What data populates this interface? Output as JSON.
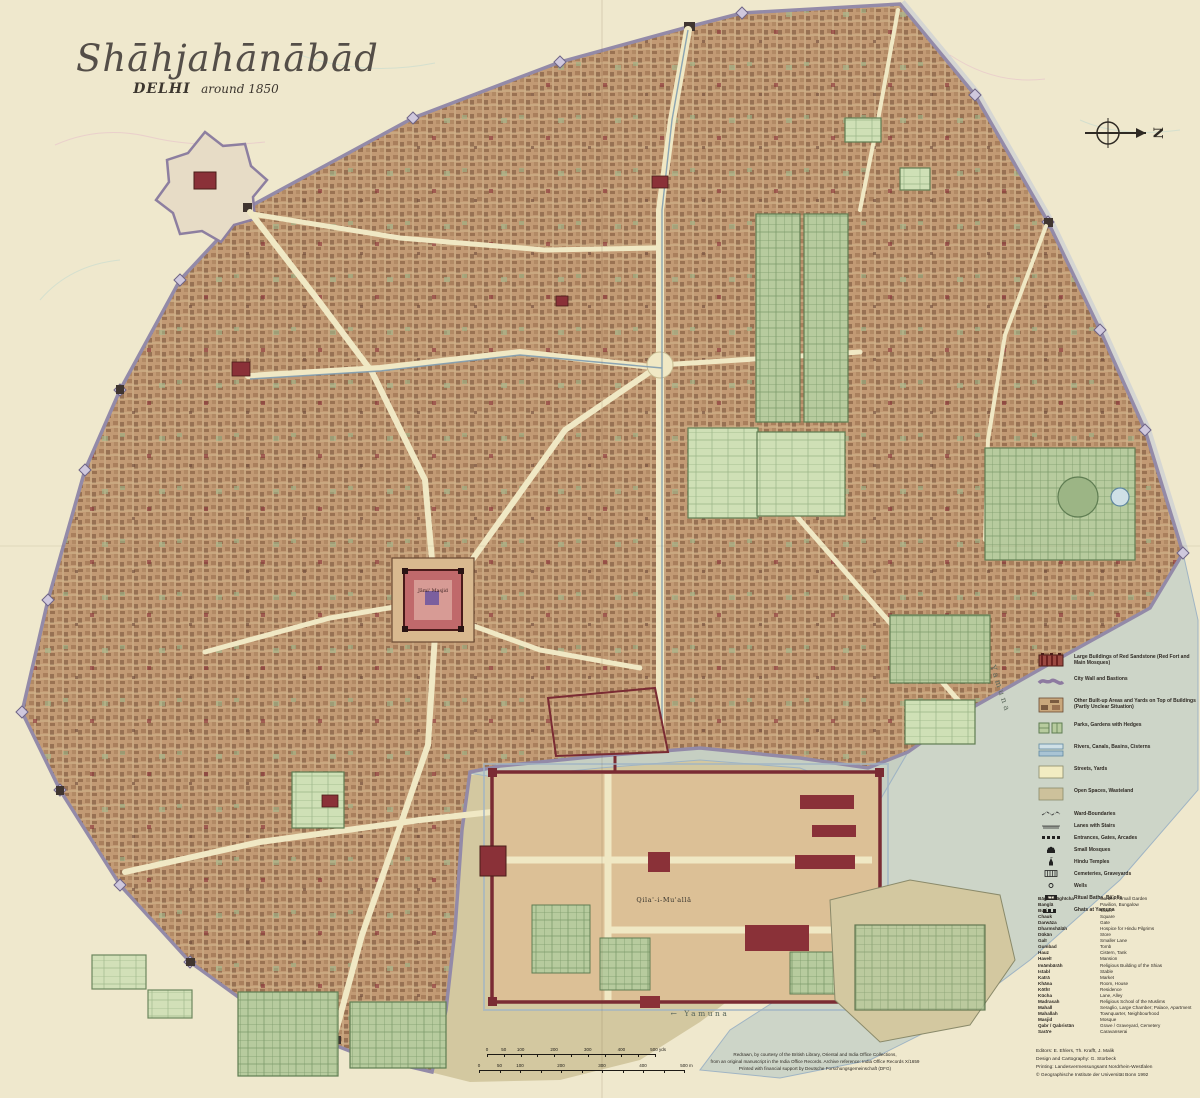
{
  "title": "Shāhjahānābād",
  "subtitle_city": "DELHI",
  "subtitle_year": "around 1850",
  "compass": {
    "label": "N"
  },
  "map_labels": {
    "fort": "Qila'-i-Mu'allā",
    "mosque": "Jāmi' Masjid",
    "river_right": "Yamuna",
    "river_bottom": "← Yamuna"
  },
  "legend": {
    "areas": [
      {
        "label": "Large Buildings of Red Sandstone (Red Fort and Main Mosques)",
        "swatch": "red-sandstone"
      },
      {
        "label": "City Wall and Bastions",
        "swatch": "city-wall"
      },
      {
        "label": "Other Built-up Areas and Yards on Top of Buildings (Partly Unclear Situation)",
        "swatch": "built-up"
      },
      {
        "label": "Parks, Gardens with Hedges",
        "swatch": "gardens"
      },
      {
        "label": "Rivers, Canals, Basins, Cisterns",
        "swatch": "water"
      },
      {
        "label": "Streets, Yards",
        "swatch": "streets"
      },
      {
        "label": "Open Spaces, Wasteland",
        "swatch": "open-spaces"
      }
    ],
    "symbols": [
      "Ward-Boundaries",
      "Lanes with Stairs",
      "Entrances, Gates, Arcades",
      "Small Mosques",
      "Hindu Temples",
      "Cemeteries, Graveyards",
      "Wells",
      "Ritual Baths, Bā'olīs",
      "Ghats at Yamuna"
    ]
  },
  "glossary": [
    [
      "Bāgh / Bāghīcha",
      "Garden / Small Garden"
    ],
    [
      "Banglā",
      "Pavilion, Bungalow"
    ],
    [
      "Burj",
      "Tower"
    ],
    [
      "Chauk",
      "Square"
    ],
    [
      "Darwāza",
      "Gate"
    ],
    [
      "Dharmshālāh",
      "Hospice for Hindu Pilgrims"
    ],
    [
      "Dūkān",
      "Store"
    ],
    [
      "Galī",
      "Smaller Lane"
    ],
    [
      "Gumbad",
      "Tomb"
    ],
    [
      "Hauz",
      "Cistern, Tank"
    ],
    [
      "Havelī",
      "Mansion"
    ],
    [
      "Imāmbārāh",
      "Religious Building of the Shias"
    ],
    [
      "Istabl",
      "Stable"
    ],
    [
      "Katrā",
      "Market"
    ],
    [
      "Khāna",
      "Room, House"
    ],
    [
      "Kōthī",
      "Residence"
    ],
    [
      "Kūcha",
      "Lane, Alley"
    ],
    [
      "Madrasah",
      "Religious School of the Muslims"
    ],
    [
      "Mahall",
      "Seraglio, Large Chamber; Palace, Apartment"
    ],
    [
      "Mahallah",
      "Townquarter, Neighbourhood"
    ],
    [
      "Masjid",
      "Mosque"
    ],
    [
      "Qabr / Qabristān",
      "Grave / Graveyard, Cemetery"
    ],
    [
      "Sarā'e",
      "Caravanserai"
    ]
  ],
  "scale": {
    "yards": {
      "ticks": [
        "0",
        "50",
        "100",
        "200",
        "300",
        "400",
        "500 yds"
      ]
    },
    "meters": {
      "ticks": [
        "0",
        "50",
        "100",
        "200",
        "300",
        "400",
        "500 m"
      ]
    }
  },
  "credits_center": [
    "Redrawn, by courtesy of the British Library, Oriental and India Office Collections,",
    "from an original manuscript in the India Office Records. Archive reference: India Office Records X/1659",
    "Printed with financial support by Deutsche Forschungsgemeinschaft (DFG)"
  ],
  "credits_right": [
    "Editors: E. Ehlers, Th. Krafft, J. Malik",
    "Design and Cartography: G. Storbeck",
    "Printing: Landesvermessungsamt Nordrhein-Westfalen",
    "© Geographische Institute der Universität Bonn 1992"
  ],
  "colors": {
    "paper": "#efe8cd",
    "built_up": "#c29a74",
    "city_wall": "#938aa8",
    "water": "#cdd5c8",
    "garden": "#b7cb9e",
    "fort_red": "#7a2b33",
    "red_sandstone": "#9c4a42",
    "street": "#f0e8c4",
    "sand": "#d3c8a0"
  }
}
